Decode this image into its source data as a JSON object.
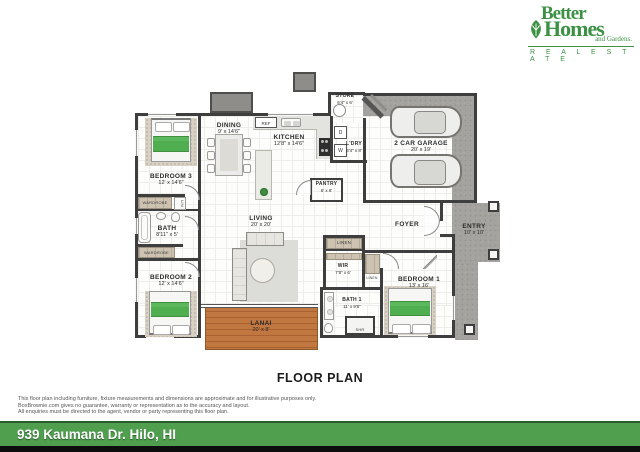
{
  "logo": {
    "line1": "Better",
    "line2": "Homes",
    "line3": "and Gardens.",
    "line4": "R E A L   E S T A T E",
    "brand_green": "#3c9144"
  },
  "title": "FLOOR PLAN",
  "address": "939 Kaumana Dr. Hilo, HI",
  "disclaimer": [
    "This floor plan including furniture, fixture measurements and dimensions are approximate and for illustrative purposes only.",
    "BoxBrownie.com gives no guarantee, warranty or representation as to the accuracy and layout.",
    "All enquiries must be directed to the agent, vendor or party representing this floor plan."
  ],
  "colors": {
    "address_bar": "#4f9f4f",
    "walls": "#3e3e3e",
    "lanai_wood": "#b96f3c",
    "bed_green": "#4fae4f",
    "concrete": "#a5a39f"
  },
  "rooms": {
    "store": {
      "name": "STORE",
      "dims": "6'4\" x 6'"
    },
    "garage": {
      "name": "2 CAR GARAGE",
      "dims": "20' x 19'"
    },
    "dining": {
      "name": "DINING",
      "dims": "9' x 14'6\""
    },
    "kitchen": {
      "name": "KITCHEN",
      "dims": "12'8\" x 14'6\""
    },
    "ldry": {
      "name": "L'DRY",
      "dims": "6'4\" x 8'"
    },
    "pantry": {
      "name": "PANTRY",
      "dims": "6' x 6'"
    },
    "bedroom3": {
      "name": "BEDROOM 3",
      "dims": "12' x 14'6\""
    },
    "bath": {
      "name": "BATH",
      "dims": "8'11\" x 5'"
    },
    "bedroom2": {
      "name": "BEDROOM 2",
      "dims": "12' x 14'6\""
    },
    "living": {
      "name": "LIVING",
      "dims": "20' x 20'"
    },
    "foyer": {
      "name": "FOYER"
    },
    "entry": {
      "name": "ENTRY",
      "dims": "10' x 10'"
    },
    "wir": {
      "name": "WIR",
      "dims": "7'8\" x 6'"
    },
    "bath1": {
      "name": "BATH 1",
      "dims": "11' x 9'6\""
    },
    "bedroom1": {
      "name": "BEDROOM 1",
      "dims": "13' x 16'"
    },
    "lanai": {
      "name": "LANAI",
      "dims": "20' x 8'"
    }
  },
  "small_labels": {
    "ref": "REF",
    "wardrobe": "WARDROBE",
    "lin": "LIN",
    "linen": "LINEN",
    "shr": "SHR",
    "dryer": "D",
    "washer": "W"
  }
}
